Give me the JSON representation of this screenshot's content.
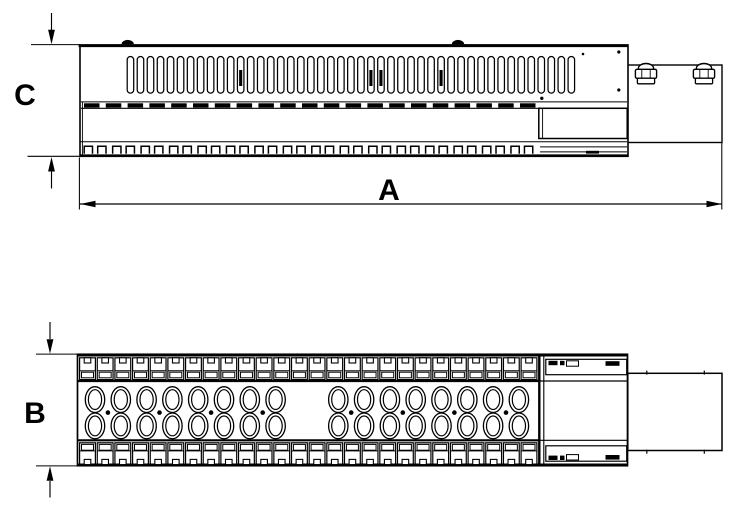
{
  "drawing": {
    "labels": {
      "length": "A",
      "width": "B",
      "height": "C"
    },
    "colors": {
      "line": "#000000",
      "background": "#ffffff"
    }
  }
}
